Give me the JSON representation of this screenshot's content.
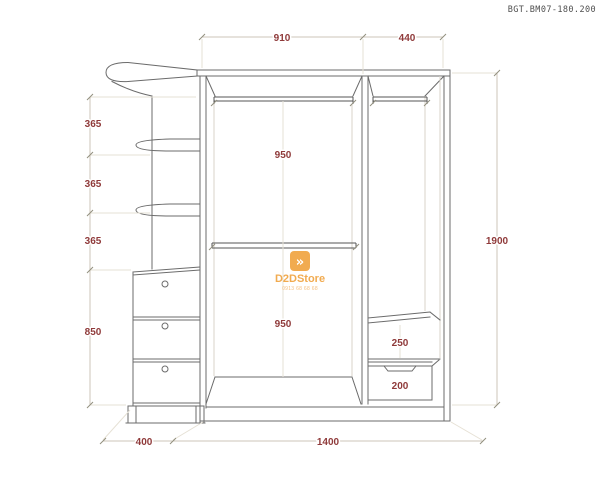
{
  "header": {
    "doc_code": "BGT.BM07-180.200"
  },
  "watermark": {
    "logo_glyph": "»",
    "brand": "D2DStore",
    "phone": "0913 68 68 68",
    "accent_color": "#f0a23e"
  },
  "dims": {
    "top_910": "910",
    "top_440": "440",
    "left_365a": "365",
    "left_365b": "365",
    "left_365c": "365",
    "left_850": "850",
    "mid_950a": "950",
    "mid_950b": "950",
    "right_1900": "1900",
    "right_250": "250",
    "right_200": "200",
    "bottom_400": "400",
    "bottom_1400": "1400"
  },
  "colors": {
    "dimension_text": "#8f3a3a",
    "drawing_line": "#6b6b6b",
    "dimension_line": "#cdc6b8"
  }
}
